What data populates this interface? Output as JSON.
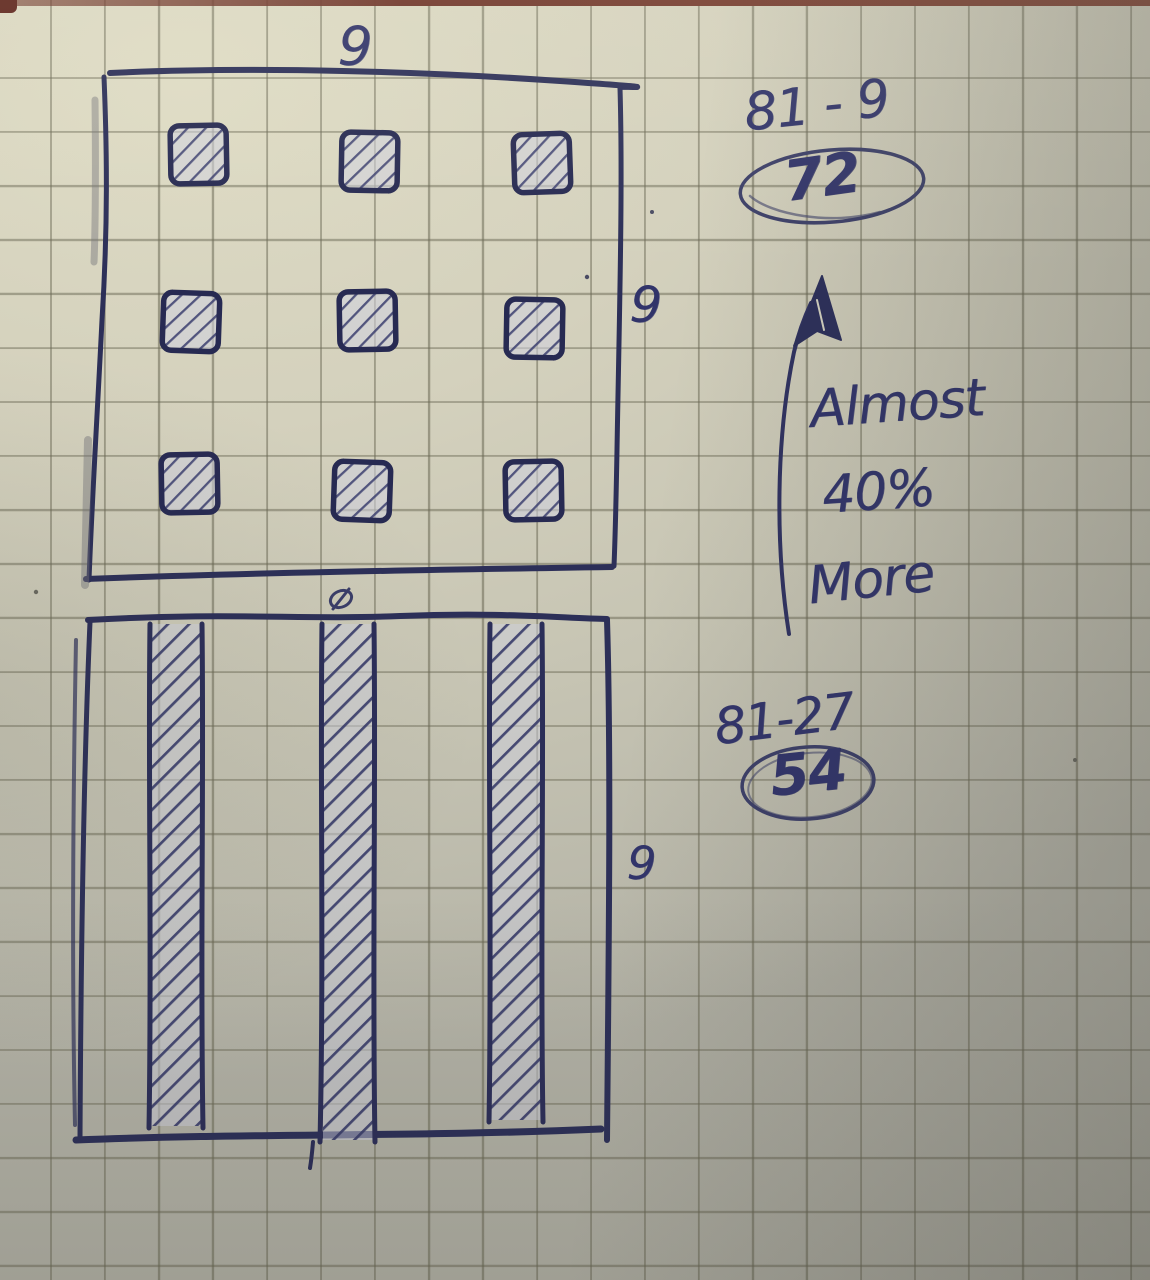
{
  "photo": {
    "description": "Hand-drawn math sketch in blue pen on squared notebook paper",
    "ink_color": "#32356b",
    "paper_color": "#d6d3bf",
    "grid_line_color": "#6a6854",
    "table_edge_color": "#6e3429"
  },
  "top_figure": {
    "type": "square-grid",
    "width_label": "9",
    "height_label": "9",
    "rows": 3,
    "cols": 3,
    "shaded_cells": 9
  },
  "bottom_figure": {
    "type": "square-with-columns",
    "height_label": "9",
    "shaded_columns": 3
  },
  "calculations": [
    {
      "expression": "81 - 9",
      "result": "72"
    },
    {
      "expression": "81-27",
      "result": "54"
    }
  ],
  "note": {
    "lines": [
      "Almost",
      "40%",
      "More"
    ]
  },
  "marks": {
    "arrow": "up-arrow",
    "between_figures": "slashed-oval-mark"
  }
}
